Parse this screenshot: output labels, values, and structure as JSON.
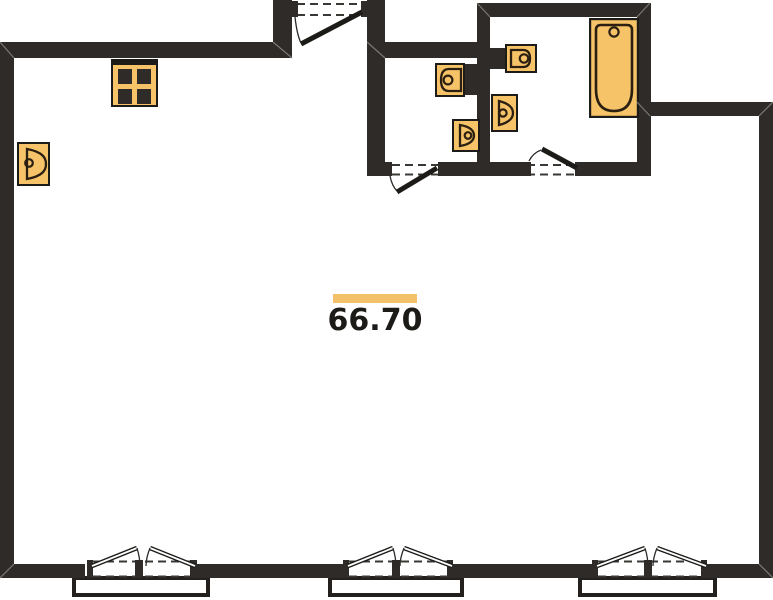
{
  "plan": {
    "area_label": "66.70"
  },
  "colors": {
    "background": "#ffffff",
    "wall": "#2e2b28",
    "fixture": "#f6c368",
    "fixture-outline": "#2b1f12",
    "line": "#1d1b18",
    "accent-bar": "#f3c169",
    "text": "#1d1b18",
    "miter": "#8a8680",
    "dash": "#3a3835"
  },
  "symbols": {
    "stove-icon": "square-with-4-burners",
    "sink-icon": "basin-outline-with-faucet-dot",
    "bathtub-icon": "rounded-tub-with-drain-dot",
    "door-icon": "swing-leaf-with-arc",
    "window-icon": "double-casement-with-dashed-opening"
  }
}
